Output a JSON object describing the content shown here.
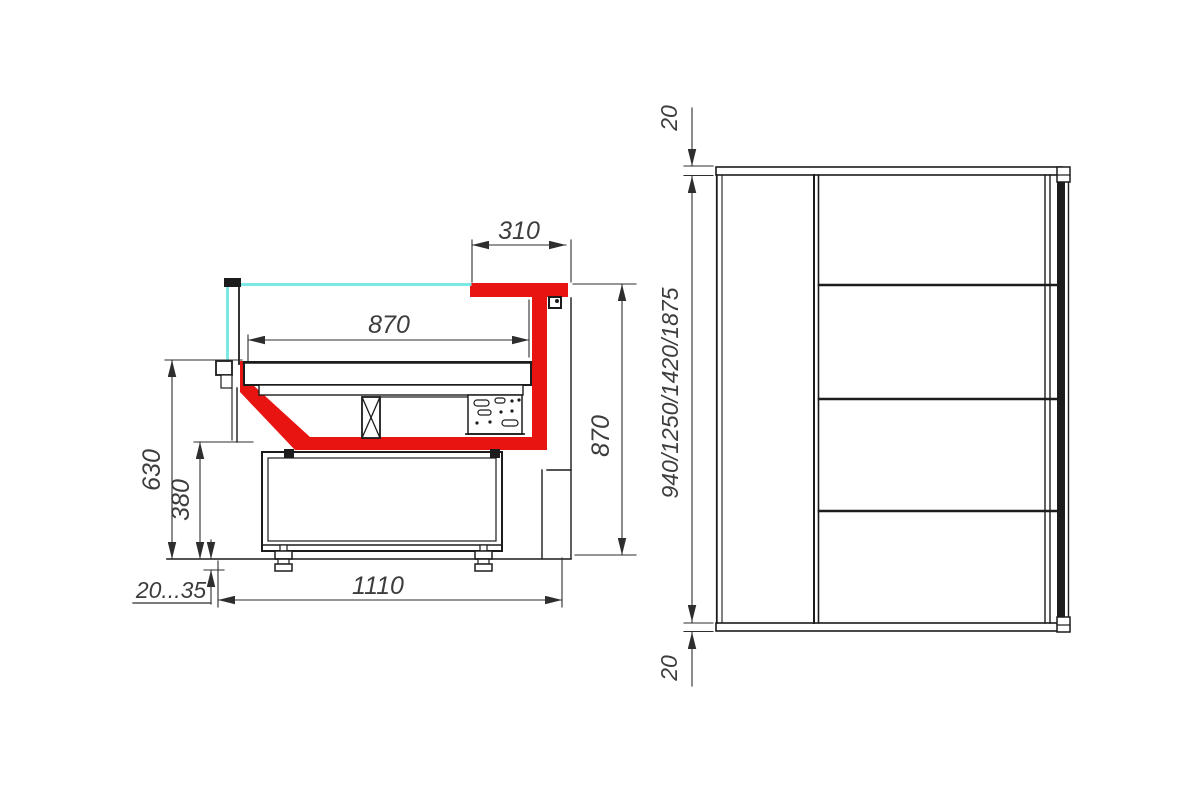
{
  "diagram": {
    "type": "technical-drawing",
    "subject": "refrigerated-display-case",
    "views": {
      "section": {
        "name": "cross-section view",
        "dims": {
          "canopy_depth": "310",
          "deck_depth": "870",
          "front_height": "630",
          "base_height": "380",
          "foot_adjust": "20...35",
          "base_depth": "1110",
          "rear_height": "870"
        }
      },
      "front": {
        "name": "side elevation view",
        "shelf_count": 4,
        "dims": {
          "top_panel": "20",
          "overall_heights": "940/1250/1420/1875",
          "bottom_panel": "20"
        }
      }
    },
    "colors": {
      "body_red": "#e81411",
      "glass_cyan": "#7de9e6",
      "line": "#1c1c1c",
      "dim_line": "#2e2e2e",
      "dim_text": "#3d3d3d",
      "background": "#ffffff"
    }
  }
}
